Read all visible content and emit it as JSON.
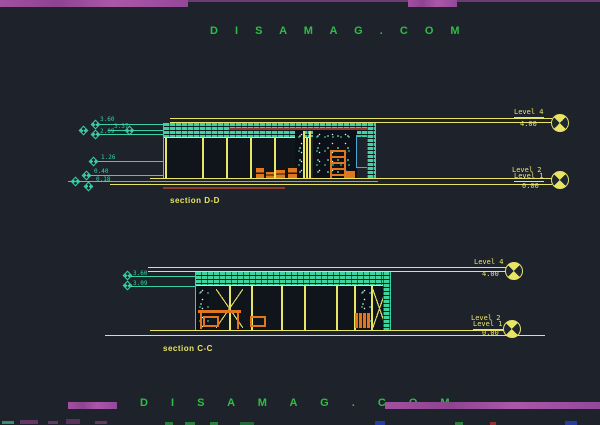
{
  "colors": {
    "background": "#1d222b",
    "cad_yellow": "#e8e565",
    "cad_cyan": "#38d2a6",
    "cad_orange": "#e0761e",
    "banner_purple": "#9d4f9b",
    "brand_green": "#2fbe44"
  },
  "branding": {
    "top_text": "D I S A M A G . C O M",
    "bottom_text": "D I S A M A G . C O M"
  },
  "section_dd": {
    "title": "section D-D",
    "elev_1": "3.60",
    "elev_2": "3.37",
    "elev_3": "2.09",
    "elev_4": "1.26",
    "elev_5": "0.40",
    "elev_6": "0.18",
    "level_top_name": "Level 4",
    "level_top_value": "4.00",
    "level_mid_name": "Level 2",
    "level_bot_name": "Level 1",
    "level_bot_value": "0.00"
  },
  "section_cc": {
    "title": "section C-C",
    "elev_1": "3.60",
    "elev_2": "3.09",
    "level_top_name": "Level 4",
    "level_top_value": "4.00",
    "level_mid_name": "Level 2",
    "level_bot_name": "Level 1",
    "level_bot_value": "0.00"
  }
}
